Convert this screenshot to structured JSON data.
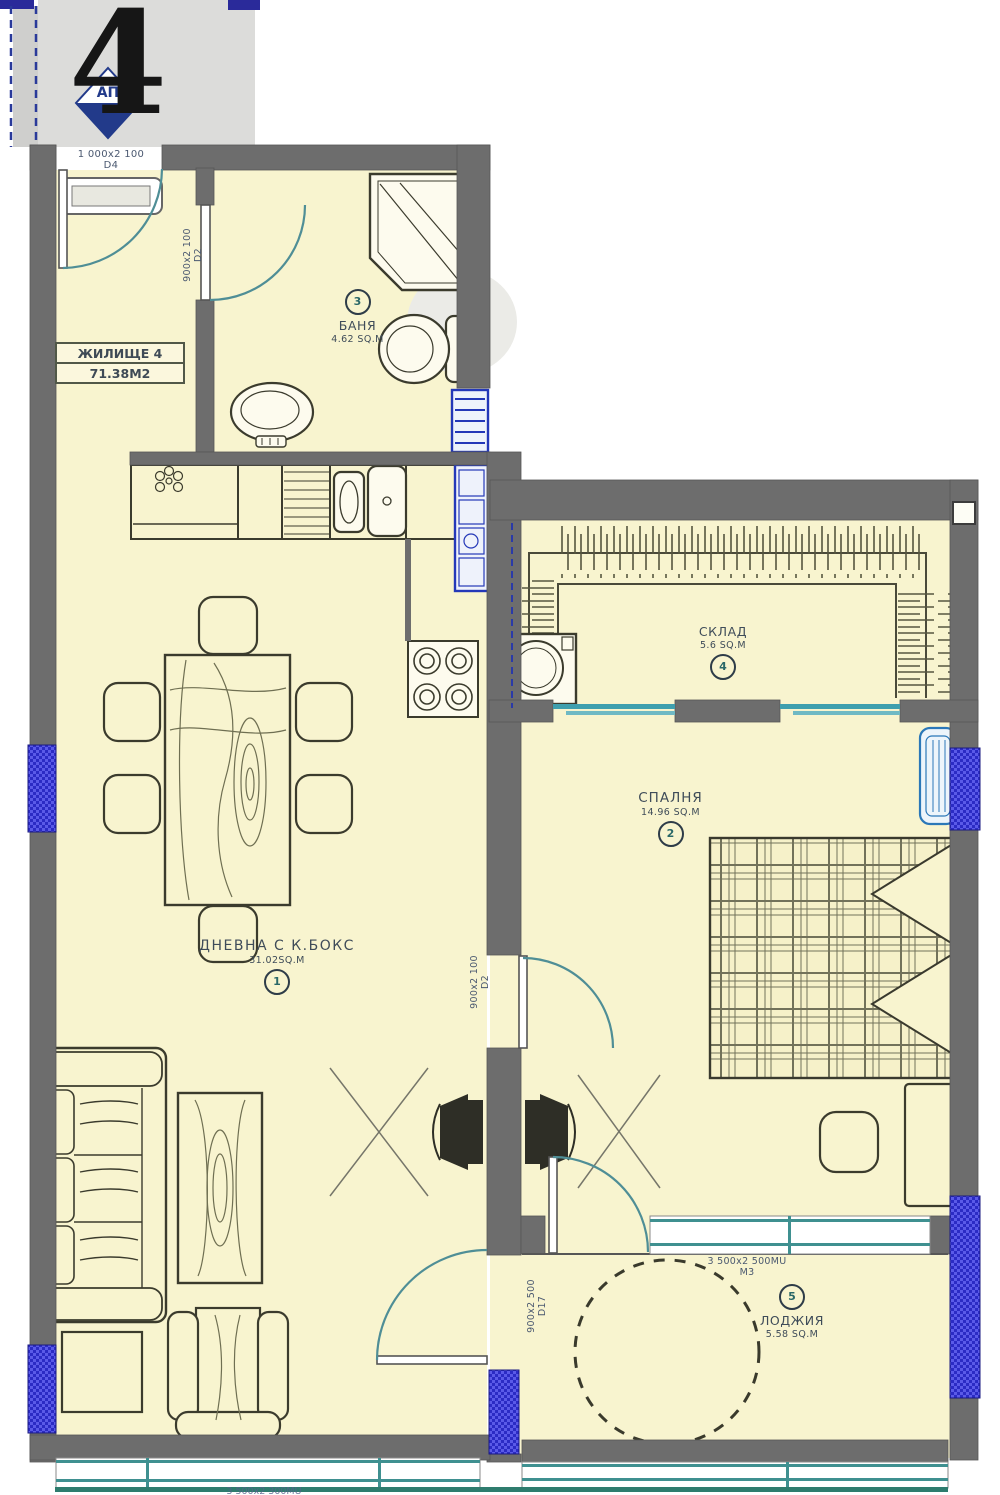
{
  "header": {
    "apartment_number": "4",
    "logo_text": "АП"
  },
  "unit_label": {
    "title": "ЖИЛИЩЕ 4",
    "area": "71.38М2"
  },
  "rooms": {
    "living": {
      "number": "1",
      "name": "ДНЕВНА С К.БОКС",
      "area": "31.02SQ.M"
    },
    "bedroom": {
      "number": "2",
      "name": "СПАЛНЯ",
      "area": "14.96 SQ.M"
    },
    "bath": {
      "number": "3",
      "name": "БАНЯ",
      "area": "4.62 SQ.M"
    },
    "storage": {
      "number": "4",
      "name": "СКЛАД",
      "area": "5.6 SQ.M"
    },
    "loggia": {
      "number": "5",
      "name": "ЛОДЖИЯ",
      "area": "5.58 SQ.M"
    }
  },
  "doors": {
    "entry": {
      "size": "1 000х2 100",
      "mark": "D4"
    },
    "bath": {
      "size": "900х2 100",
      "mark": "D2"
    },
    "bedroom": {
      "size": "900х2 100",
      "mark": "D2"
    },
    "loggia": {
      "size": "900х2 500",
      "mark": "D17"
    }
  },
  "windows": {
    "loggia": {
      "size": "3 500х2 500МU",
      "mark": "М3"
    },
    "living_bottom": {
      "size": "3 500х2 300МU"
    }
  },
  "colors": {
    "floor": "#f8f4cf",
    "wall": "#6d6d6d",
    "window_blue": "#2b2bc4",
    "glazing_teal": "#3f9090",
    "fixture_blue": "#2438b8",
    "label_text": "#3f4c59"
  }
}
